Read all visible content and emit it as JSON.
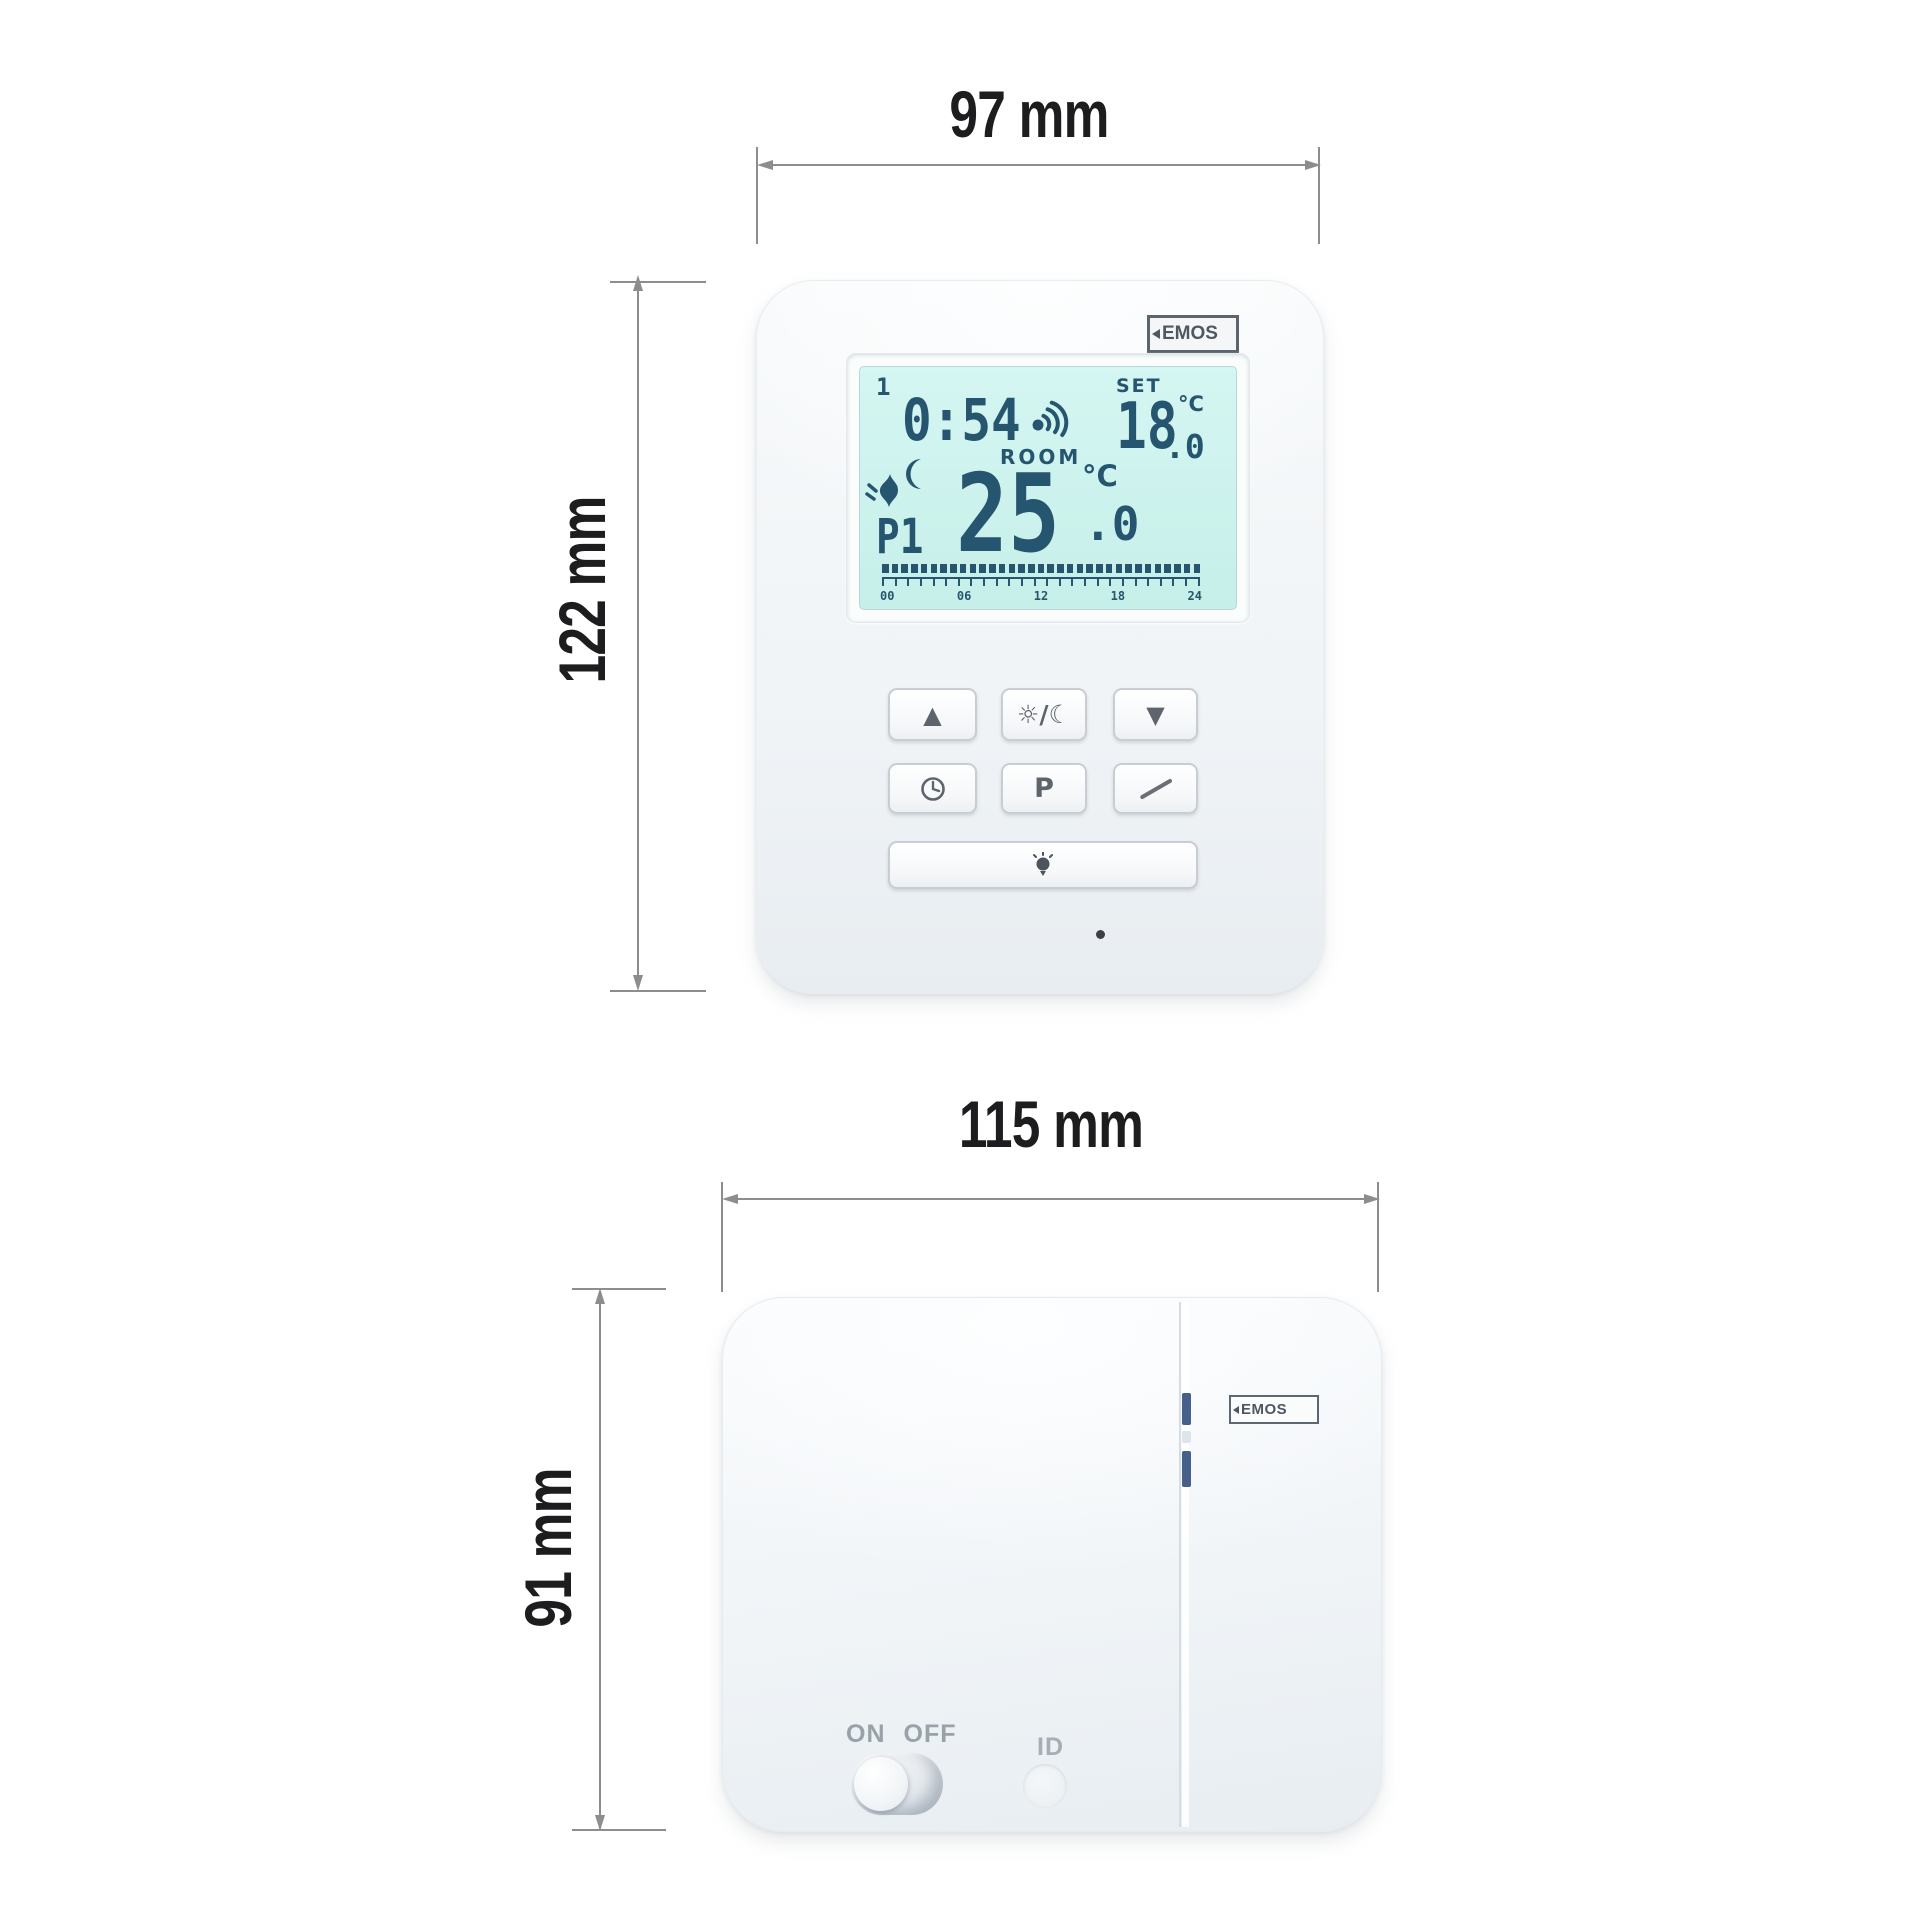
{
  "dimensions": {
    "thermostat_width": "97 mm",
    "thermostat_height": "122 mm",
    "receiver_width": "115 mm",
    "receiver_height": "91 mm"
  },
  "thermostat": {
    "brand": "EMOS",
    "lcd": {
      "day": "1",
      "time": "0:54",
      "set_label": "SET",
      "set_temp": "18",
      "set_temp_decimal": ".0",
      "set_unit": "°C",
      "room_label": "ROOM",
      "room_temp": "25",
      "room_temp_decimal": ".0",
      "room_unit": "°C",
      "program": "P1",
      "timeline": {
        "segments": 33,
        "ticks": 26,
        "hours": [
          "00",
          "06",
          "12",
          "18",
          "24"
        ]
      }
    },
    "buttons": {
      "up": "▲",
      "day_night": "☼/☾",
      "down": "▼",
      "program": "P"
    }
  },
  "receiver": {
    "brand": "EMOS",
    "power_on": "ON",
    "power_off": "OFF",
    "id": "ID"
  },
  "colors": {
    "lcd_background": "#cdf2ee",
    "lcd_ink": "#26556f",
    "dimension_line": "#8d8d8d",
    "dimension_text": "#1d1d1f",
    "receiver_led": "#47608a",
    "label_gray": "#99a1a9"
  }
}
